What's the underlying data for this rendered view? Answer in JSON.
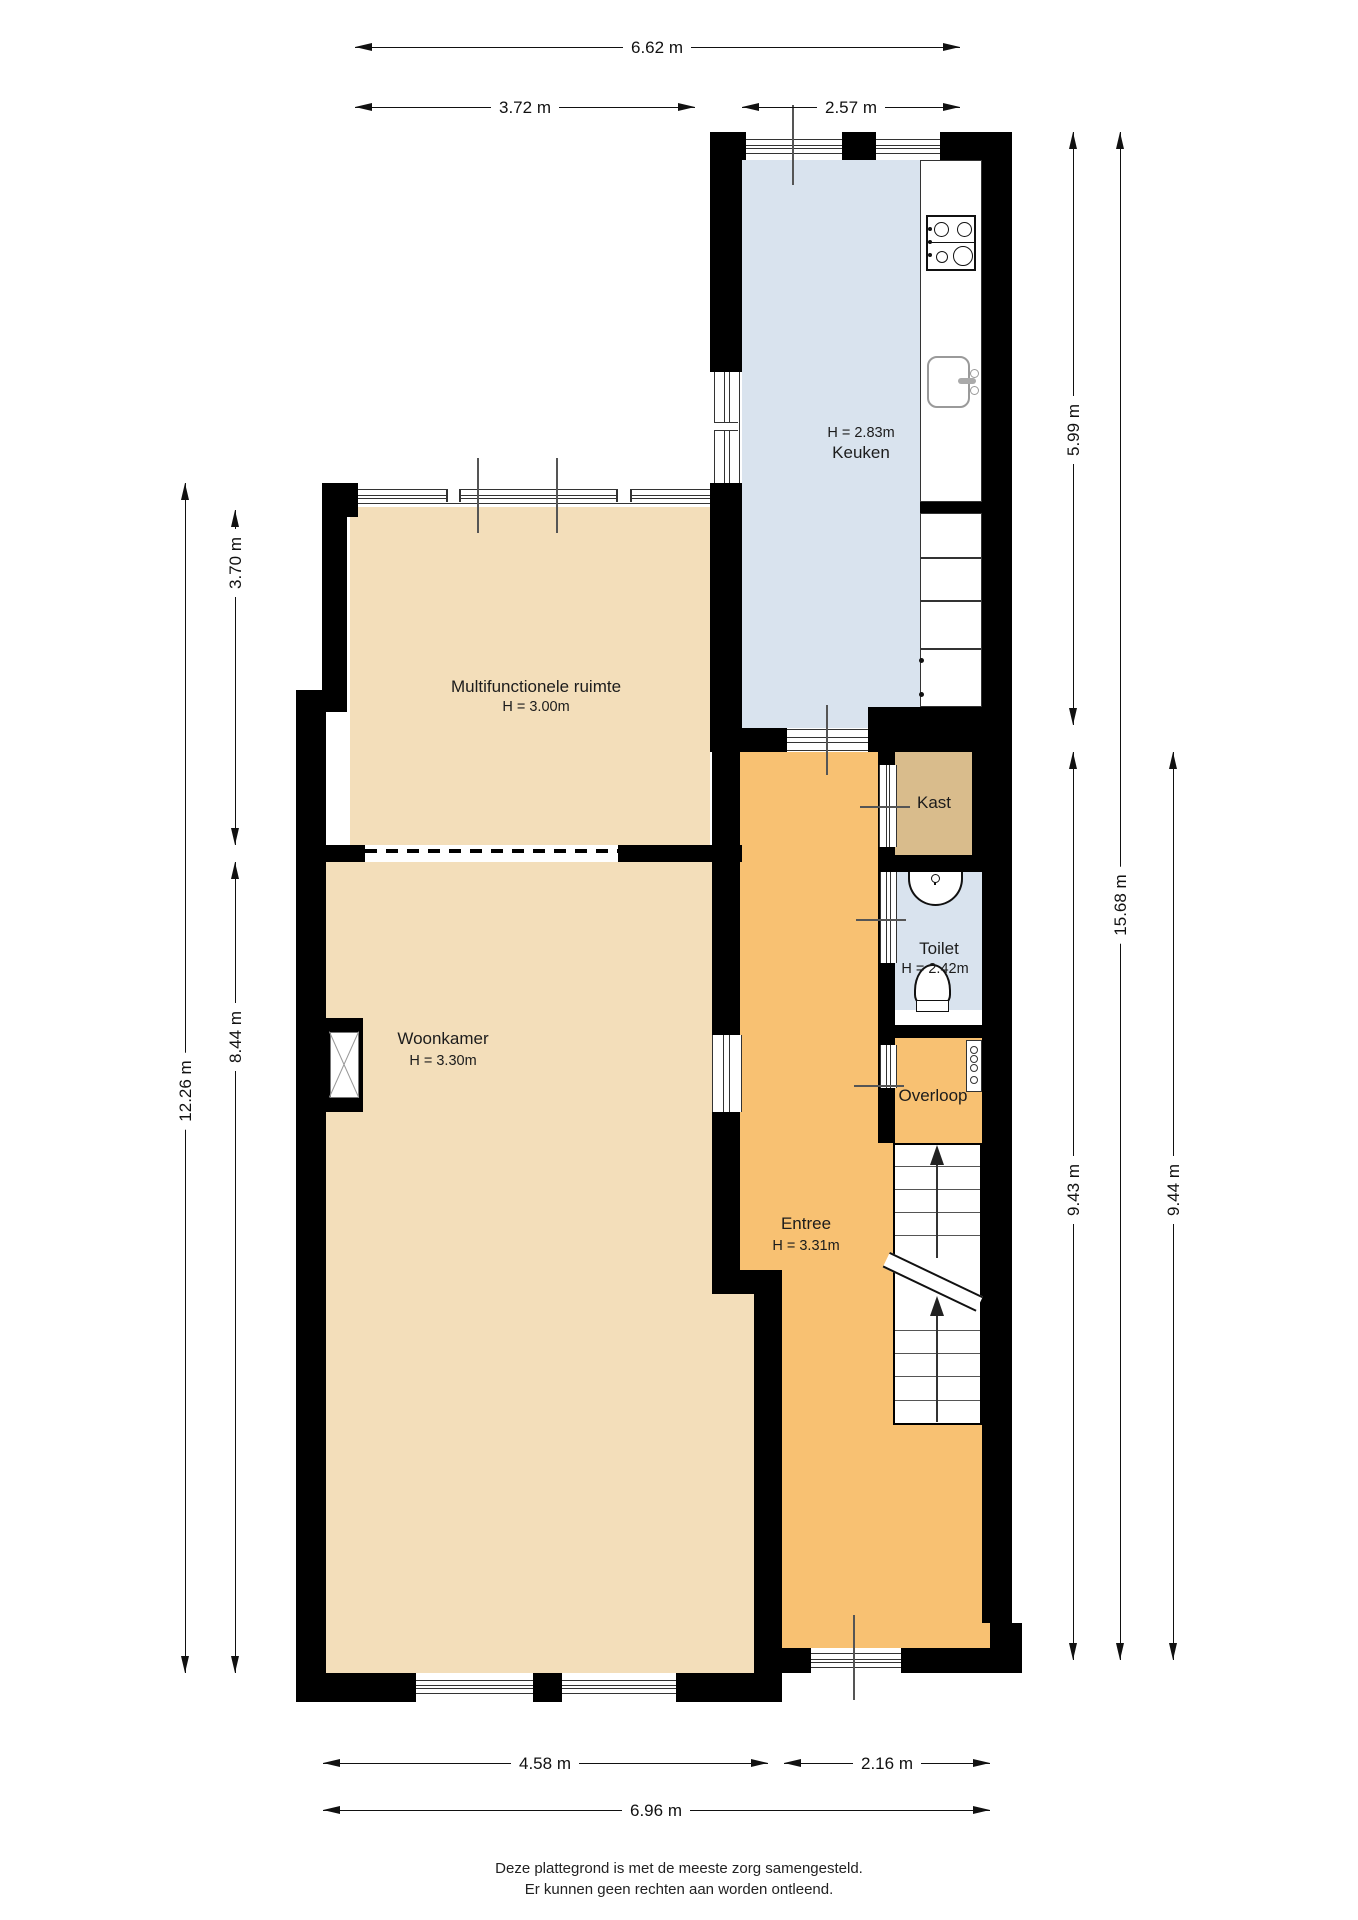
{
  "rooms": {
    "keuken": {
      "name": "Keuken",
      "height": "H = 2.83m"
    },
    "multifunctionele_ruimte": {
      "name": "Multifunctionele ruimte",
      "height": "H = 3.00m"
    },
    "woonkamer": {
      "name": "Woonkamer",
      "height": "H = 3.30m"
    },
    "entree": {
      "name": "Entree",
      "height": "H = 3.31m"
    },
    "toilet": {
      "name": "Toilet",
      "height": "H = 2.42m"
    },
    "kast": {
      "name": "Kast"
    },
    "overloop": {
      "name": "Overloop"
    }
  },
  "dimensions": {
    "top": {
      "total": "6.62 m",
      "left": "3.72 m",
      "right": "2.57 m"
    },
    "left": {
      "upper": "3.70 m",
      "total": "12.26 m",
      "lower": "8.44 m"
    },
    "right": {
      "upper": "5.99 m",
      "total": "15.68 m",
      "lower_inner": "9.43 m",
      "lower_outer": "9.44 m"
    },
    "bottom": {
      "left": "4.58 m",
      "right": "2.16 m",
      "total": "6.96 m"
    }
  },
  "footer": {
    "line1": "Deze plattegrond is met de meeste zorg samengesteld.",
    "line2": "Er kunnen geen rechten aan worden ontleend."
  },
  "colors": {
    "floor_tan": "#f3deba",
    "floor_orange": "#f8c172",
    "floor_blue": "#d9e3ee",
    "floor_kast": "#d9bc8c",
    "wall": "#000000"
  }
}
